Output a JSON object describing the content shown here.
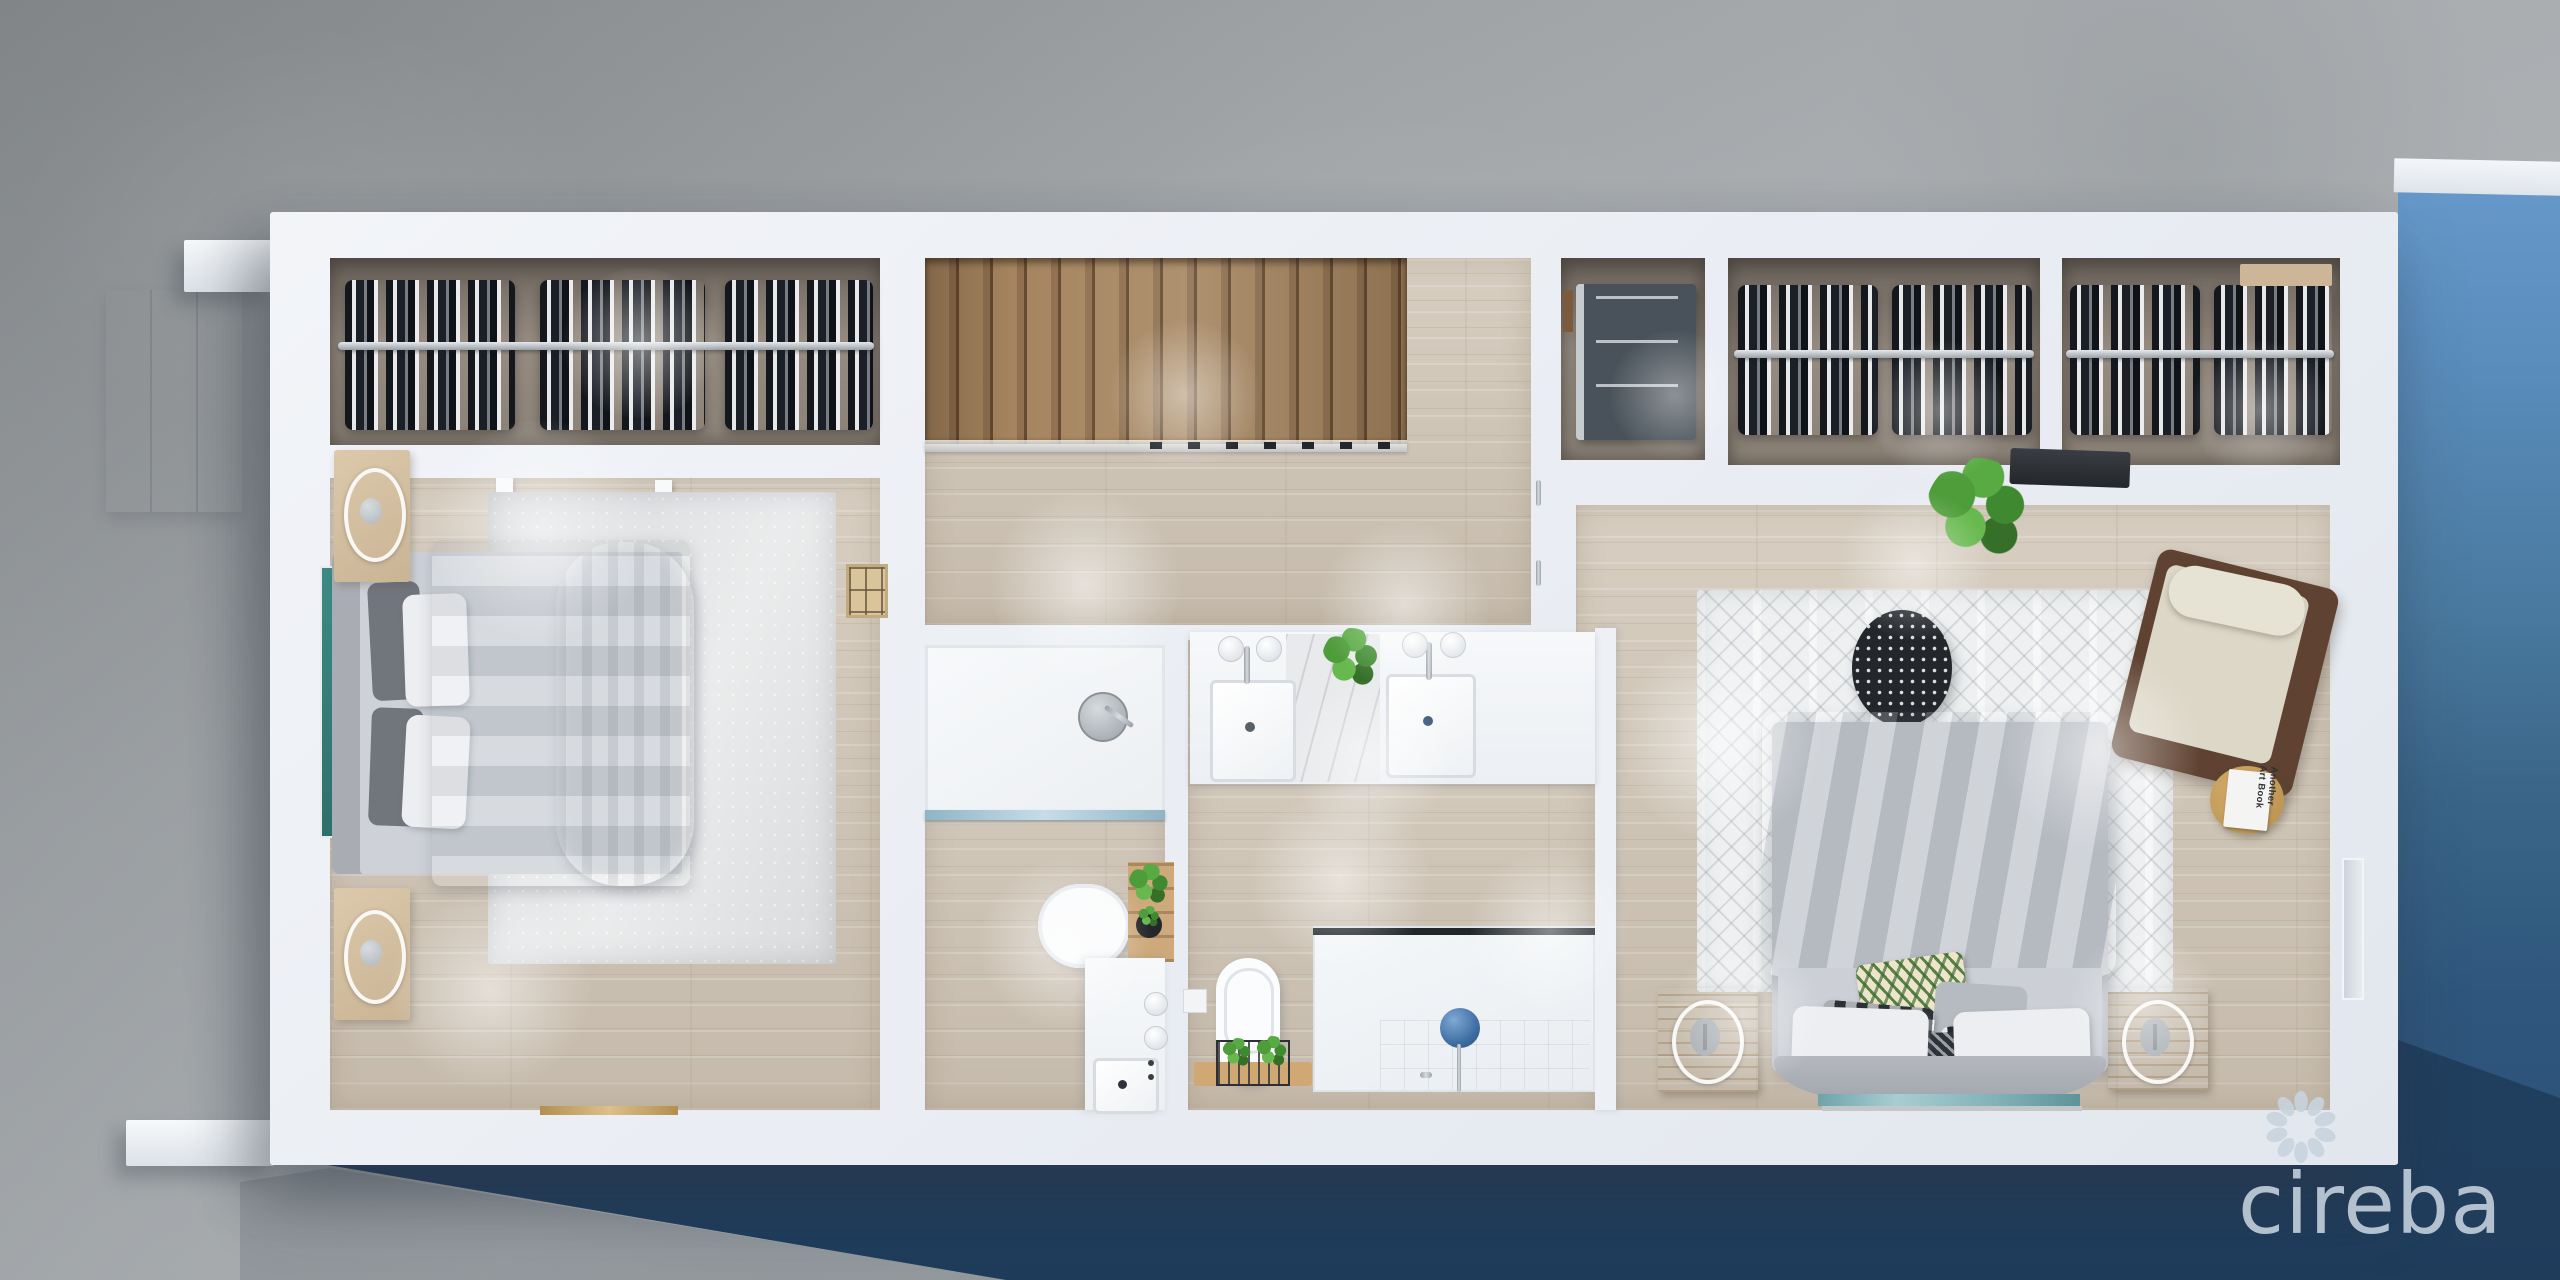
{
  "title": "3D dollhouse floor plan render, upper level, with pool",
  "watermark": {
    "text": "cireba",
    "icon": "petal-ring-logo"
  },
  "labels": {
    "book": "Another Art Book"
  },
  "colors": {
    "concrete": "#a6abae",
    "wall": "#edf0f5",
    "wood": "#d7cec1",
    "wood_dark": "#c5baab",
    "pool_top": "#72a4d8",
    "pool_mid": "#49799f",
    "pool_deep": "#2f567d",
    "logo": "#c8d4df",
    "gold": "#c7a568",
    "teal_art": "#3d8a83",
    "plant_green": "#4f9c3f",
    "stair_wood": "#97774f"
  },
  "scene": {
    "view": "top-down-3d-floorplan",
    "exterior": [
      "concrete-patio",
      "swimming-pool",
      "building-shadow",
      "pool-edge-wall"
    ],
    "rooms": [
      {
        "name": "bedroom-2",
        "furniture": [
          "closet-hanging-clothes",
          "double-bed",
          "nightstand-ring-lamp-x2",
          "area-rug",
          "leaning-artwork",
          "wall-panel",
          "gold-door-threshold"
        ]
      },
      {
        "name": "hallway-stairs",
        "furniture": [
          "wood-staircase",
          "glass-stair-railing",
          "door-handles"
        ]
      },
      {
        "name": "bathroom-2",
        "furniture": [
          "walk-in-shower",
          "glass-partition",
          "toilet",
          "ladder-plant-shelf",
          "vanity-sink",
          "wall-sconces"
        ]
      },
      {
        "name": "laundry-closet",
        "furniture": [
          "stacked-washer-dryer"
        ]
      },
      {
        "name": "walk-in-closet-a",
        "furniture": [
          "hanging-clothes-rail"
        ]
      },
      {
        "name": "walk-in-closet-b",
        "furniture": [
          "hanging-clothes-rail",
          "wall-shelf"
        ]
      },
      {
        "name": "master-bathroom",
        "furniture": [
          "double-vanity",
          "twin-sinks",
          "wall-lamps",
          "marble-splash",
          "counter-plant",
          "toilet",
          "plant-basket-tray",
          "rain-shower"
        ]
      },
      {
        "name": "master-bedroom",
        "furniture": [
          "king-bed",
          "patterned-pillows",
          "gold-nightstand-x2",
          "round-ottoman",
          "accent-armchair",
          "side-table-with-book",
          "floor-plant",
          "wall-console",
          "trellis-rug",
          "sliding-glass-door",
          "wall-window"
        ]
      }
    ]
  }
}
